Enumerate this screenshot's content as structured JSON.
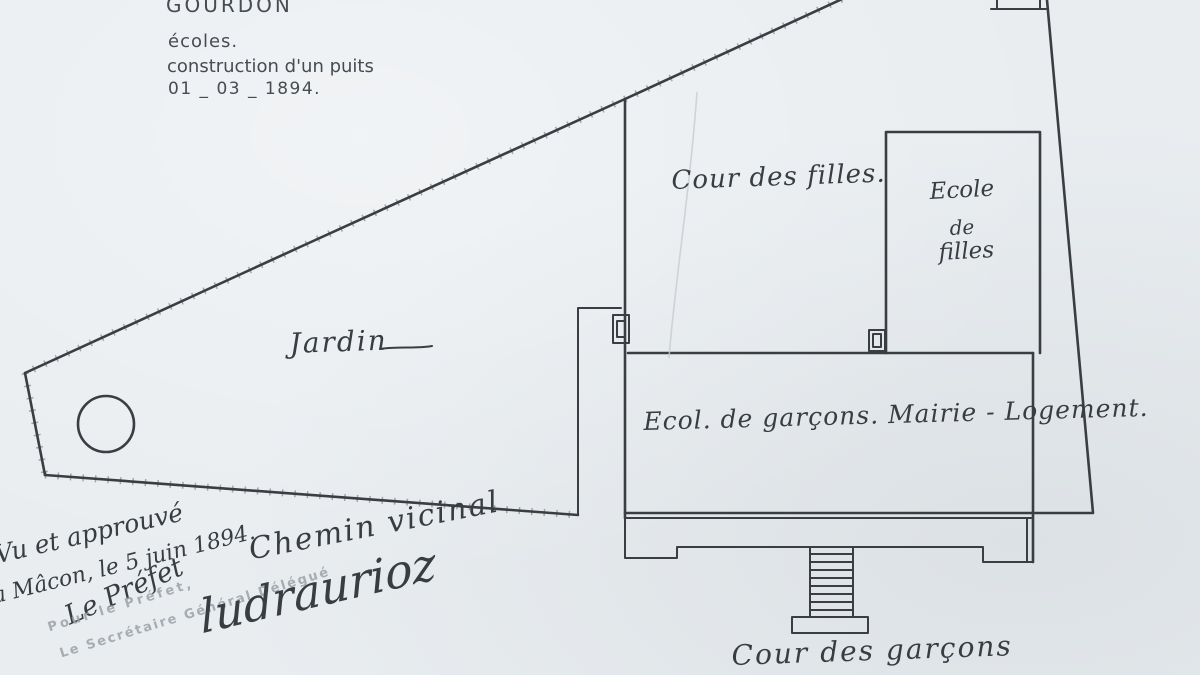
{
  "colors": {
    "paper": "#e9edf0",
    "ink": "#34383c",
    "stamp_ink": "#9aa1a8"
  },
  "header": {
    "commune": "GOURDON",
    "object_line": "écoles.",
    "work_line": "construction d'un puits",
    "date_line": "01 _ 03 _ 1894."
  },
  "plan": {
    "jardin": "Jardin",
    "cour_des_filles": "Cour des filles.",
    "ecole_filles_1": "Ecole",
    "ecole_filles_2": "de",
    "ecole_filles_3": "filles",
    "batiment": "Ecol. de garçons. Mairie - Logement.",
    "cour_des_garcons": "Cour des garçons",
    "chemin_vicinal": "Chemin vicinal"
  },
  "approval": {
    "vu": "Vu et approuvé",
    "lieu_date": "à Mâcon, le 5 juin 1894.",
    "prefet": "Le Préfet",
    "stamp_1": "Pour le Préfet,",
    "stamp_2": "Le Secrétaire Général Délégué",
    "signature": "ludraurioz"
  }
}
